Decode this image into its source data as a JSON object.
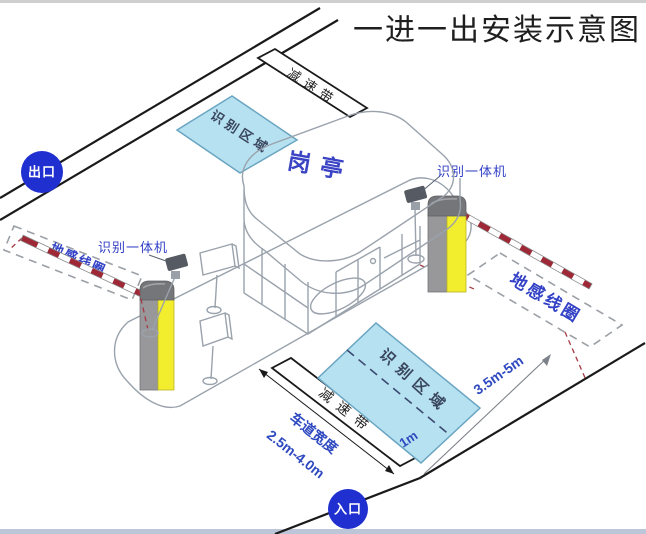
{
  "title": "一进一出安装示意图",
  "badges": {
    "exit": "出口",
    "entrance": "入口"
  },
  "booth": {
    "label": "岗亭"
  },
  "labels": {
    "camera_left": "识别一体机",
    "camera_right": "识别一体机",
    "coil_left": "地感线圈",
    "coil_right": "地感线圈",
    "recognition_top": "识别区域",
    "recognition_bottom": "识别区域",
    "speed_bump_top": "减速带",
    "speed_bump_bottom": "减速带"
  },
  "measurements": {
    "coil_distance": "3.5m-5m",
    "centerline_offset": "1m",
    "lane_width_label": "车道宽度",
    "lane_width_value": "2.5m-4.0m"
  },
  "colors": {
    "badge_blue": "#202fd0",
    "label_blue": "#3241c6",
    "area_fill": "#b6e1f0",
    "area_stroke": "#6aa5c2",
    "arm_red": "#9e2836",
    "machine_yellow": "#f2ee2e",
    "machine_gray": "#98989b"
  }
}
